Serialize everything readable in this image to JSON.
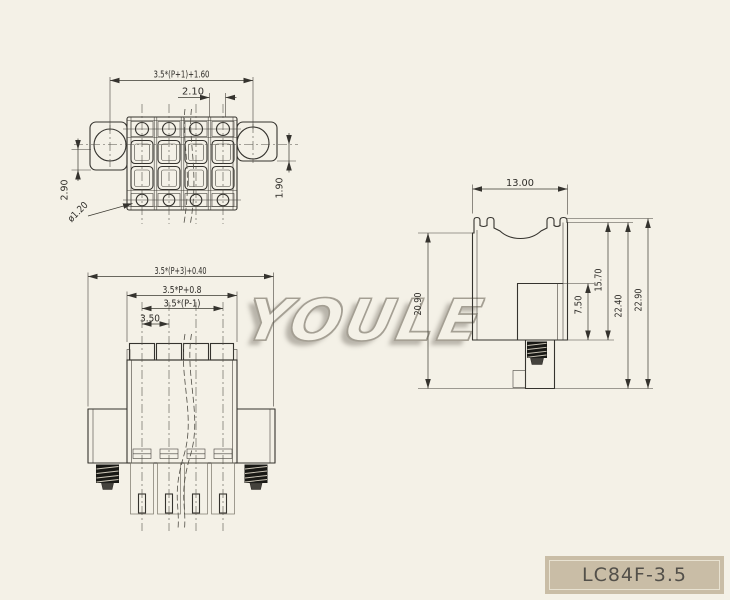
{
  "part_number": "LC84F-3.5",
  "watermark": "YOULE",
  "colors": {
    "background": "#f4f1e7",
    "line": "#35332e",
    "label_bg": "#c9bda6",
    "label_text": "#53504a"
  },
  "top_view": {
    "dim_mount_pitch": "3.5*(P+1)+1.60",
    "dim_slot": "2.10",
    "dim_left_height": "2.90",
    "dim_right_height": "1.90",
    "dim_hole_dia": "ø1.20"
  },
  "front_view": {
    "dim_overall": "3.5*(P+3)+0.40",
    "dim_body": "3.5*P+0.8",
    "dim_pin_span": "3.5*(P-1)",
    "dim_pitch": "3.50"
  },
  "side_view": {
    "dim_width": "13.00",
    "dim_body_height": "20.90",
    "dim_boss_height": "7.50",
    "dim_upper_height": "15.70",
    "dim_total_a": "22.40",
    "dim_total_b": "22.90"
  }
}
